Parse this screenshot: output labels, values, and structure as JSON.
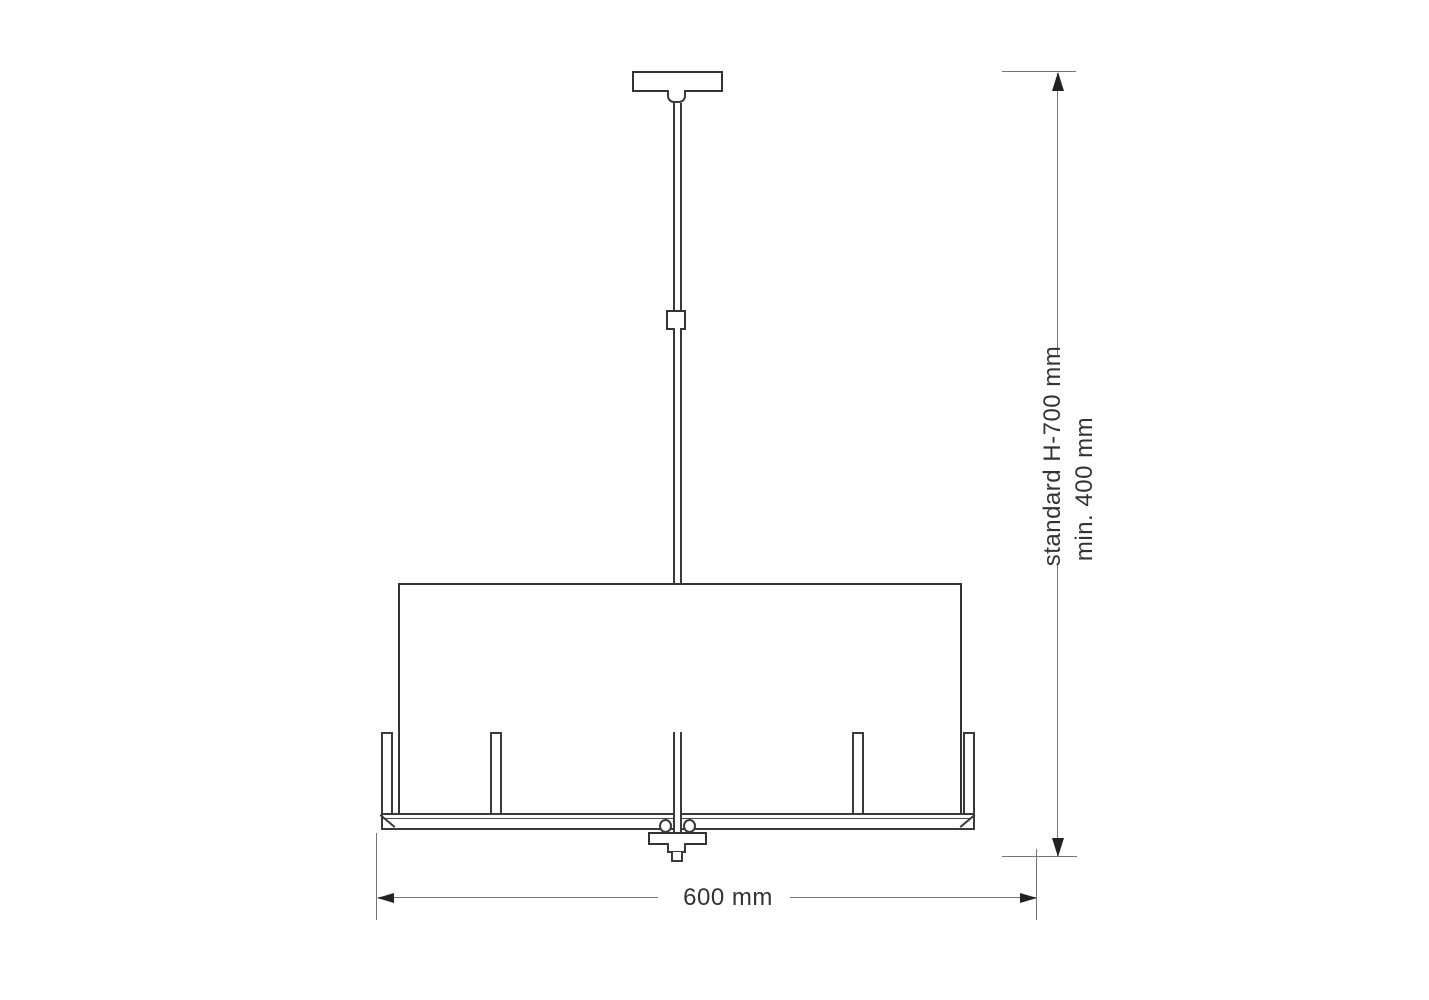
{
  "diagram": {
    "subject": "pendant-lamp-dimension-drawing",
    "dimensions": {
      "width_label": "600 mm",
      "height_standard_label": "standard H-700 mm",
      "height_min_label": "min. 400 mm"
    },
    "colors": {
      "background": "#ffffff",
      "outline": "#333333",
      "dimension_line": "#767676",
      "arrowhead": "#222222",
      "text": "#333333"
    },
    "parts": [
      "ceiling-canopy",
      "canopy-neck",
      "hanging-rod",
      "rod-coupler",
      "drum-shade",
      "frame-ring",
      "candle-arm",
      "rod-collar",
      "bottom-hub",
      "finial"
    ]
  }
}
